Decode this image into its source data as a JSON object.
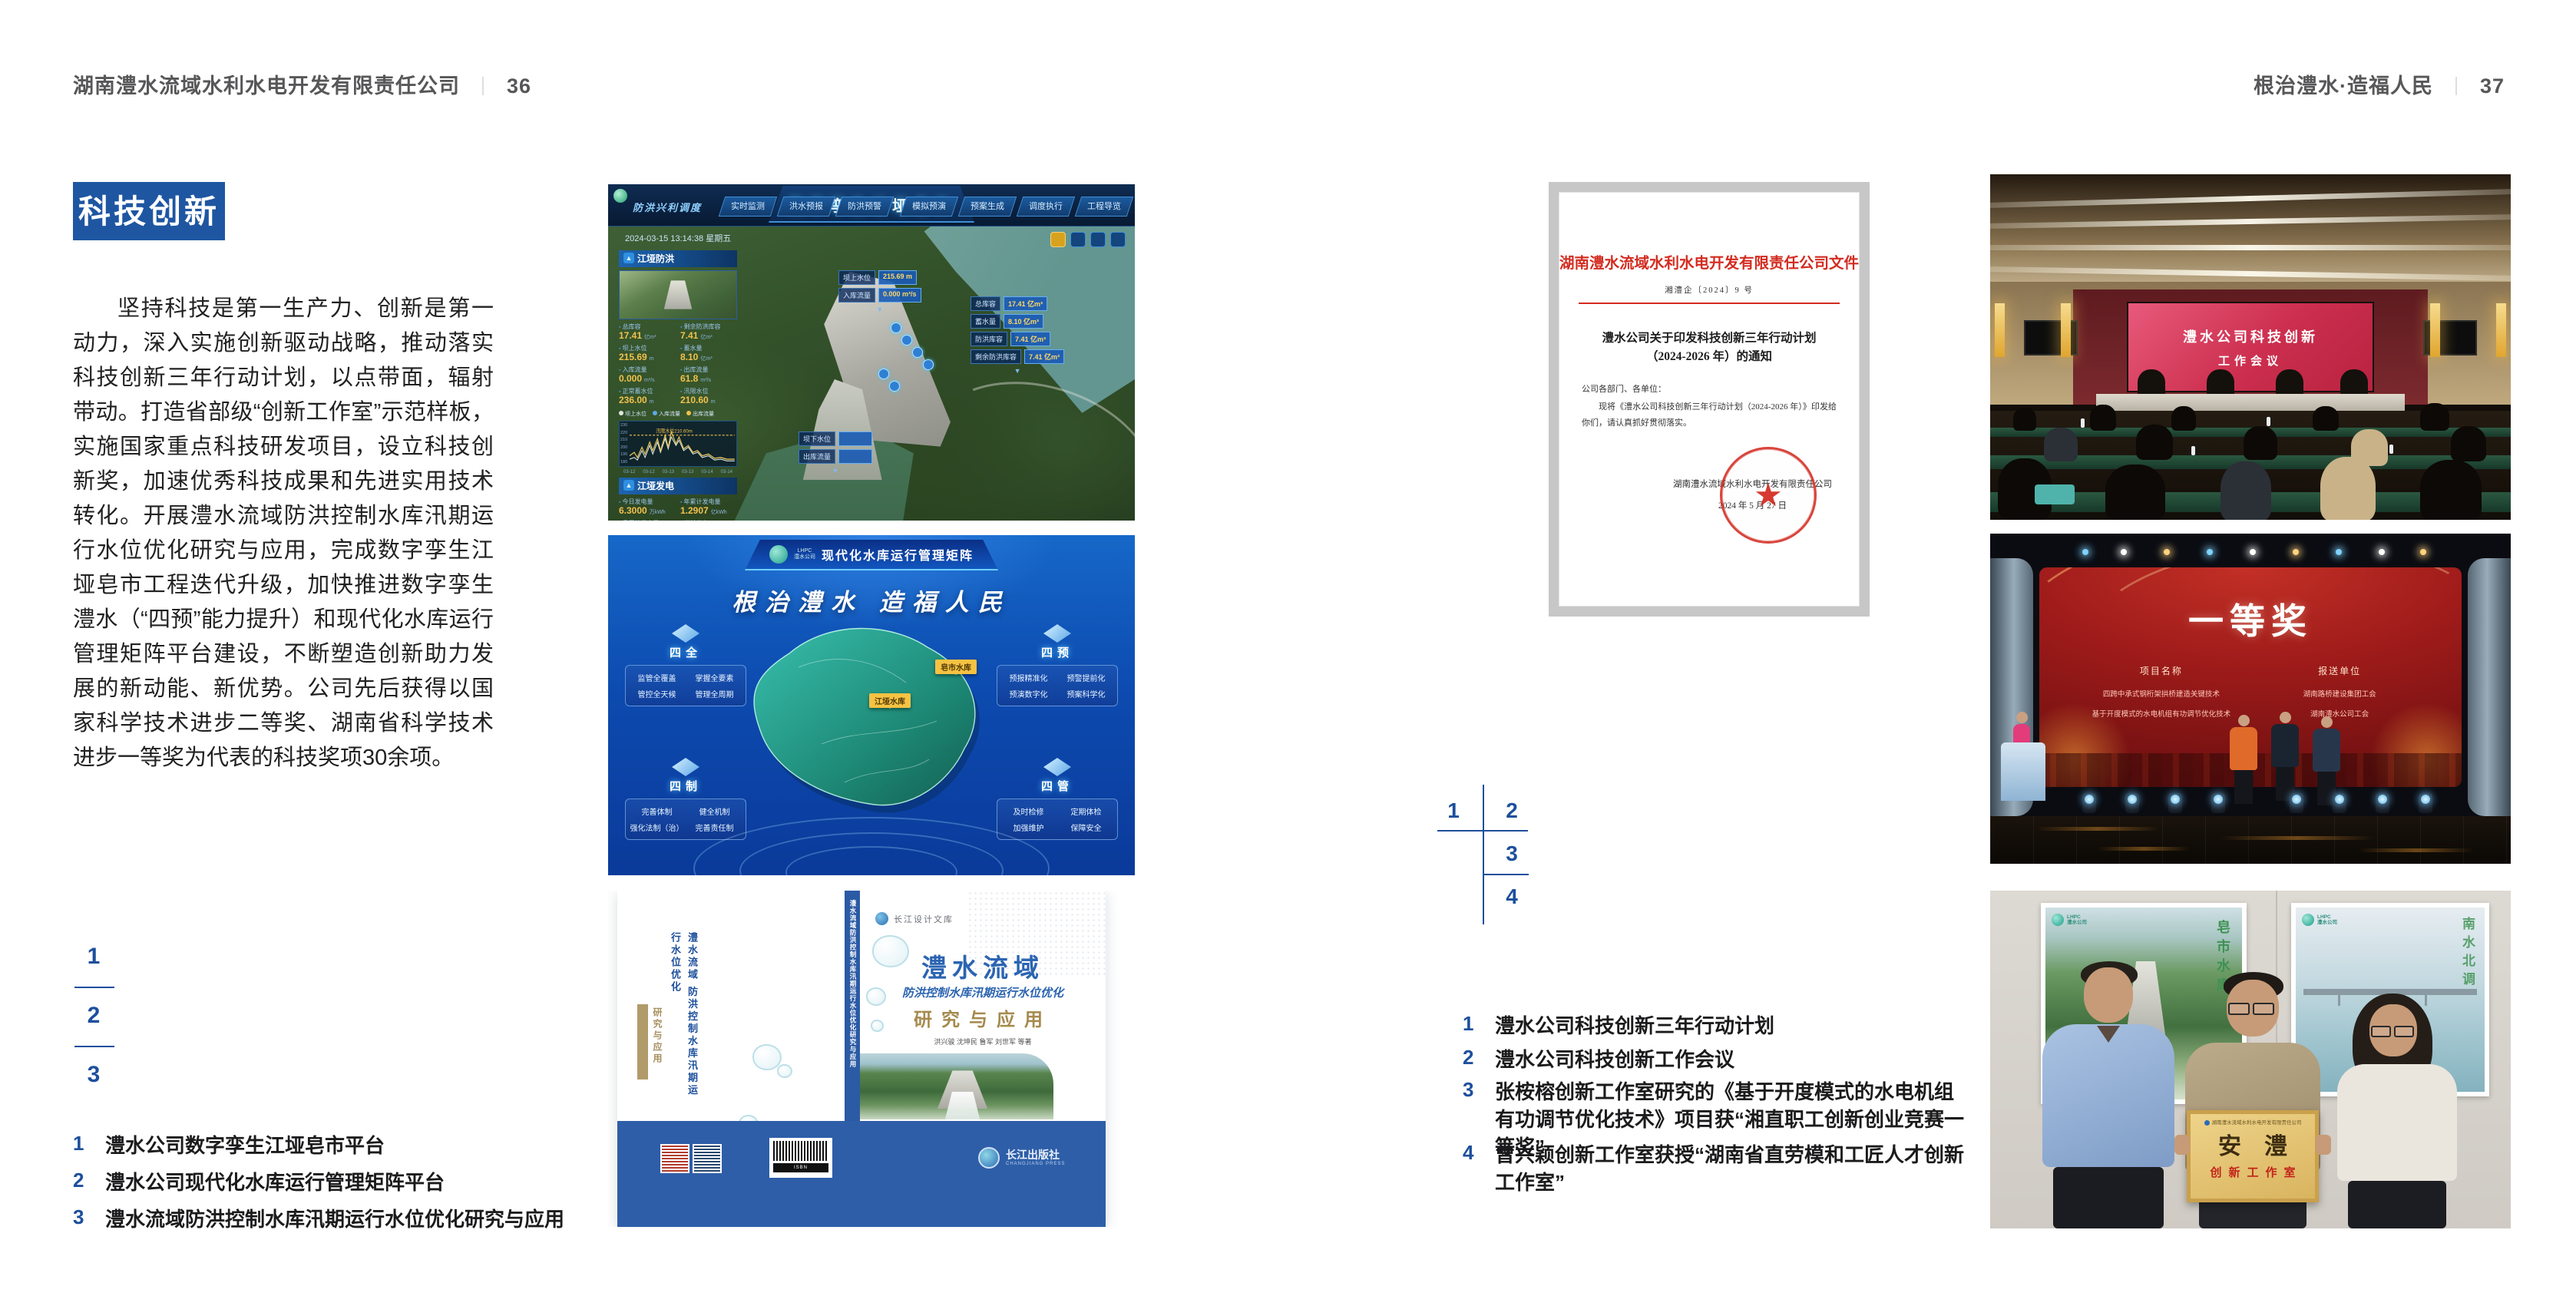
{
  "colors": {
    "accent_blue": "#1e56a2",
    "caption_blue": "#1d4f9c",
    "doc_red": "#d32b1f",
    "gold": "#a58a4e"
  },
  "lhpc": {
    "short": "LHPC",
    "name": "澧水公司"
  },
  "header": {
    "left": {
      "company": "湖南澧水流域水利水电开发有限责任公司",
      "divider": "｜",
      "page": "36"
    },
    "right": {
      "slogan": "根治澧水·造福人民",
      "divider": "｜",
      "page": "37"
    }
  },
  "left_page": {
    "section_title": "科技创新",
    "body": "坚持科技是第一生产力、创新是第一动力，深入实施创新驱动战略，推动落实科技创新三年行动计划，以点带面，辐射带动。打造省部级“创新工作室”示范样板，实施国家重点科技研发项目，设立科技创新奖，加速优秀科技成果和先进实用技术转化。开展澧水流域防洪控制水库汛期运行水位优化研究与应用，完成数字孪生江垭皂市工程迭代升级，加快推进数字孪生澧水（“四预”能力提升）和现代化水库运行管理矩阵平台建设，不断塑造创新助力发展的新动能、新优势。公司先后获得以国家科学技术进步二等奖、湖南省科学技术进步一等奖为代表的科技奖项30余项。",
    "figure_index": [
      "1",
      "2",
      "3"
    ],
    "captions": [
      {
        "num": "1",
        "text": "澧水公司数字孪生江垭皂市平台"
      },
      {
        "num": "2",
        "text": "澧水公司现代化水库运行管理矩阵平台"
      },
      {
        "num": "3",
        "text": "澧水流域防洪控制水库汛期运行水位优化研究与应用"
      }
    ]
  },
  "right_page": {
    "figure_index": [
      "1",
      "2",
      "3",
      "4"
    ],
    "captions": [
      {
        "num": "1",
        "text": "澧水公司科技创新三年行动计划"
      },
      {
        "num": "2",
        "text": "澧水公司科技创新工作会议"
      },
      {
        "num": "3",
        "text": "张桉榕创新工作室研究的《基于开度模式的水电机组有功调节优化技术》项目获“湘直职工创新创业竞赛一等奖”"
      },
      {
        "num": "4",
        "text": "曾兴颖创新工作室获授“湖南省直劳模和工匠人才创新工作室”"
      }
    ]
  },
  "dashboard": {
    "title": "数字孪生江垭皂市",
    "module": "防洪兴利调度",
    "tabs_left": [
      "实时监测",
      "洪水预报",
      "防洪预警"
    ],
    "tabs_right": [
      "模拟预演",
      "预案生成",
      "调度执行",
      "工程导览"
    ],
    "timestamp": "2024-03-15 13:14:38 星期五",
    "panel_flood": {
      "title": "江垭防洪",
      "stats": [
        {
          "label": "总库容",
          "value": "17.41",
          "unit": "亿m³"
        },
        {
          "label": "剩余防洪库容",
          "value": "7.41",
          "unit": "亿m³"
        },
        {
          "label": "坝上水位",
          "value": "215.69",
          "unit": "m"
        },
        {
          "label": "蓄水量",
          "value": "8.10",
          "unit": "亿m³"
        },
        {
          "label": "入库流量",
          "value": "0.000",
          "unit": "m³/s"
        },
        {
          "label": "出库流量",
          "value": "61.8",
          "unit": "m³/s"
        },
        {
          "label": "正常蓄水位",
          "value": "236.00",
          "unit": "m"
        },
        {
          "label": "汛限水位",
          "value": "210.60",
          "unit": "m"
        }
      ]
    },
    "chart": {
      "legend": [
        "坝上水位",
        "入库流量",
        "出库流量"
      ],
      "annotation": "汛限水位210.60m",
      "y_left": [
        "230",
        "220",
        "210",
        "200",
        "190",
        "180"
      ],
      "x_labels": [
        "03-12",
        "03-12",
        "03-13",
        "03-13",
        "03-14",
        "03-14"
      ]
    },
    "panel_power": {
      "title": "江垭发电",
      "stats": [
        {
          "label": "今日发电量",
          "value": "6.3000",
          "unit": "万kWh"
        },
        {
          "label": "年累计发电量",
          "value": "1.2907",
          "unit": "亿kWh"
        },
        {
          "label": "月累计发电量",
          "value": "3359.21",
          "unit": "万kWh"
        },
        {
          "label": "当前出力",
          "value": "0.00",
          "unit": "MW"
        },
        {
          "label": "发电流量",
          "value": "0.00",
          "unit": "m³/s"
        },
        {
          "label": "弃水流量",
          "value": "0.00",
          "unit": "m³/s"
        }
      ],
      "units": [
        {
          "name": "1号机",
          "value": "0.00"
        },
        {
          "name": "2号机",
          "value": "100.98"
        },
        {
          "name": "3号机",
          "value": "0.00"
        }
      ]
    },
    "tag_upstream": [
      {
        "label": "坝上水位",
        "value": "215.69 m"
      },
      {
        "label": "入库流量",
        "value": "0.000 m³/s"
      }
    ],
    "tag_reservoir": [
      {
        "label": "总库容",
        "value": "17.41 亿m³"
      },
      {
        "label": "蓄水量",
        "value": "8.10 亿m³"
      },
      {
        "label": "防洪库容",
        "value": "7.41 亿m³"
      },
      {
        "label": "剩余防洪库容",
        "value": "7.41 亿m³"
      }
    ],
    "tag_downstream": [
      {
        "label": "坝下水位",
        "value": ""
      },
      {
        "label": "出库流量",
        "value": ""
      }
    ]
  },
  "matrix": {
    "title": "现代化水库运行管理矩阵",
    "slogan": "根治澧水 造福人民",
    "blocks": [
      {
        "name": "四全",
        "items": [
          "监管全覆盖",
          "掌握全要素",
          "管控全天候",
          "管理全周期"
        ]
      },
      {
        "name": "四制",
        "items": [
          "完善体制",
          "健全机制",
          "强化法制（治）",
          "完善责任制"
        ]
      },
      {
        "name": "四预",
        "items": [
          "预报精准化",
          "预警提前化",
          "预演数字化",
          "预案科学化"
        ]
      },
      {
        "name": "四管",
        "items": [
          "及时检修",
          "定期体检",
          "加强维护",
          "保障安全"
        ]
      }
    ],
    "map_tags": [
      "江垭水库",
      "皂市水库"
    ]
  },
  "book": {
    "series": "长江设计文库",
    "title_region": "澧水流域",
    "title_main": "防洪控制水库汛期运行水位优化",
    "title_sub": "研究与应用",
    "authors": "洪兴骏 沈坤民 鲁军 刘世军 等著",
    "spine": "澧水流域防洪控制水库汛期运行水位优化研究与应用",
    "barcode_label": "ISBN",
    "publisher": "长江出版社",
    "publisher_en": "CHANGJIANG PRESS"
  },
  "document": {
    "header": "湖南澧水流域水利水电开发有限责任公司文件",
    "doc_no": "湘澧企〔2024〕9 号",
    "title_line1": "澧水公司关于印发科技创新三年行动计划",
    "title_line2": "（2024-2026 年）的通知",
    "salutation": "公司各部门、各单位：",
    "body": "现将《澧水公司科技创新三年行动计划（2024-2026 年）》印发给你们，请认真抓好贯彻落实。",
    "signer": "湖南澧水流域水利水电开发有限责任公司",
    "date": "2024 年 5 月 27 日",
    "seal_star": "★"
  },
  "meeting": {
    "screen_line1": "澧水公司科技创新",
    "screen_line2": "工作会议"
  },
  "award": {
    "title": "一等奖",
    "col1_header": "项目名称",
    "col1_items": [
      "四跨中承式钢桁架拱桥建造关键技术",
      "基于开度模式的水电机组有功调节优化技术"
    ],
    "col2_header": "报送单位",
    "col2_items": [
      "湖南路桥建设集团工会",
      "湖南澧水公司工会"
    ]
  },
  "plaque": {
    "org": "湖南澧水流域水利水电开发有限责任公司",
    "name": "安澧",
    "subtitle": "创新工作室",
    "poster_left_caption": "皂市水库",
    "poster_right_caption": "南水北调"
  }
}
